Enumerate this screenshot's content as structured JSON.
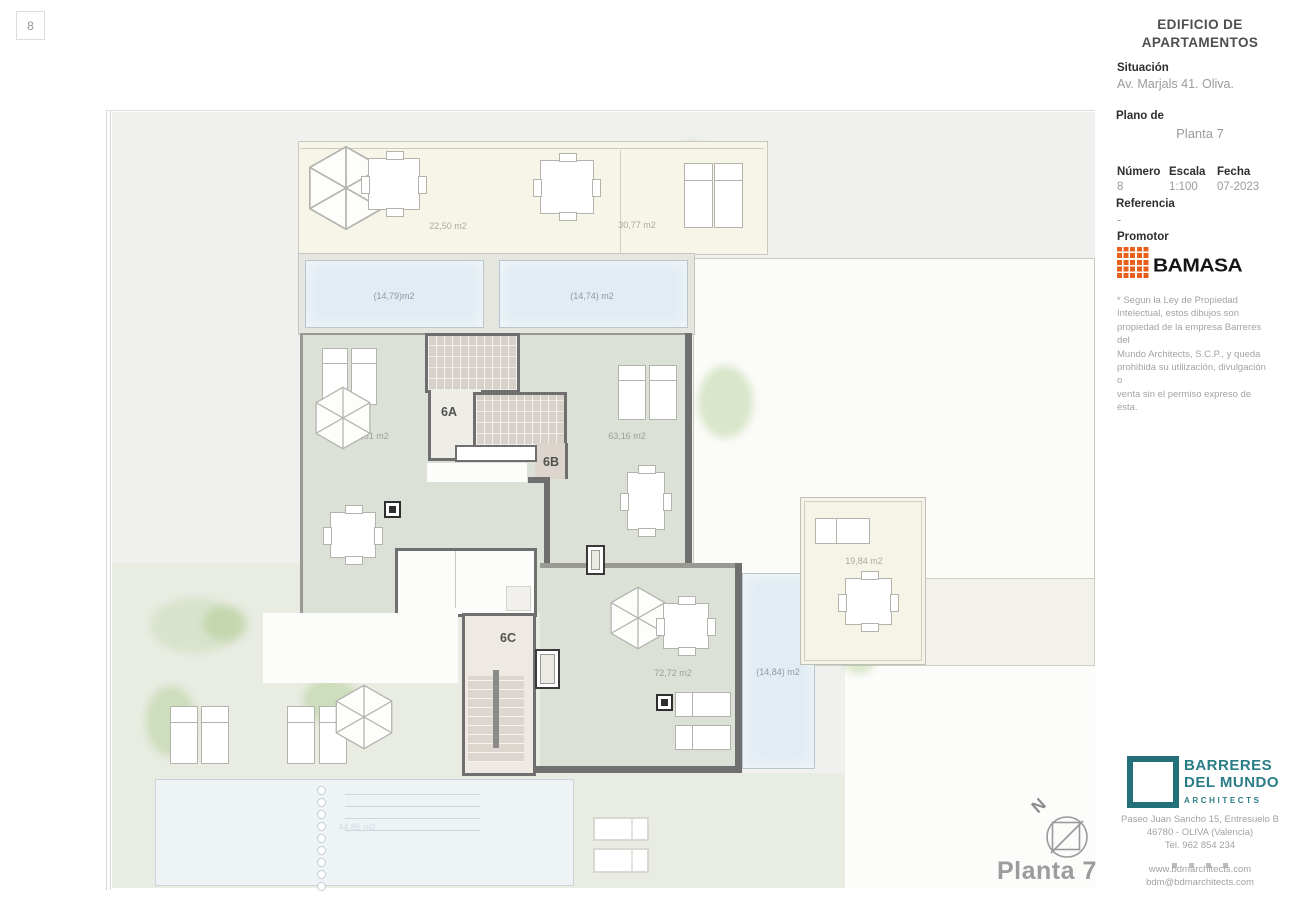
{
  "window": {
    "sheet_badge": "8"
  },
  "title_block": {
    "project_title_line1": "EDIFICIO DE",
    "project_title_line2": "APARTAMENTOS",
    "situacion": {
      "label": "Situación",
      "value": "Av. Marjals 41. Oliva."
    },
    "plano": {
      "label": "Plano de",
      "value": "Planta 7"
    },
    "numero": {
      "label": "Número",
      "value": "8"
    },
    "escala": {
      "label": "Escala",
      "value": "1:100"
    },
    "fecha": {
      "label": "Fecha",
      "value": "07-2023"
    },
    "referencia": {
      "label": "Referencia",
      "value": "-"
    },
    "promotor": {
      "label": "Promotor",
      "brand": "BAMASA"
    },
    "disclaimer": {
      "line1": "* Segun la Ley de Propiedad",
      "line2": "Intelectual, estos dibujos son",
      "line3": "propiedad de la empresa Barreres del",
      "line4": "Mundo Architects, S.C.P., y queda",
      "line5": "prohibida su utilización, divulgación o",
      "line6": "venta sin el permiso expreso de ésta."
    }
  },
  "architect": {
    "name_line1": "BARRERES",
    "name_line2": "DEL MUNDO",
    "subtitle": "ARCHITECTS",
    "address_line1": "Paseo Juan Sancho 15, Entresuelo B",
    "address_line2": "46780 - OLIVA (Valencia)",
    "phone": "Tel. 962 854 234",
    "website": "www.bdmarchitects.com",
    "email": "bdm@bdmarchitects.com"
  },
  "plan": {
    "floor_label": "Planta 7",
    "north_label": "N",
    "units": {
      "a": "6A",
      "b": "6B",
      "c": "6C"
    },
    "areas": {
      "terrace_top_left": "22,50 m2",
      "terrace_top_right": "30,77 m2",
      "pool_top_left": "(14,79)m2",
      "pool_top_right": "(14,74) m2",
      "terrace_6a": "70,51 m2",
      "terrace_6b": "63,16 m2",
      "terrace_right": "19,84 m2",
      "terrace_6c": "72,72 m2",
      "pool_6c": "(14,84) m2",
      "pool_garden": "44,85 m2"
    },
    "colors": {
      "terrace_green": "#dce1d7",
      "terrace_cream": "#f7f5e8",
      "pool_blue": "#e1ecf3",
      "wall_gray": "#6f6f6f",
      "brand_orange": "#e8601c",
      "brand_teal": "#2a7d85"
    }
  }
}
